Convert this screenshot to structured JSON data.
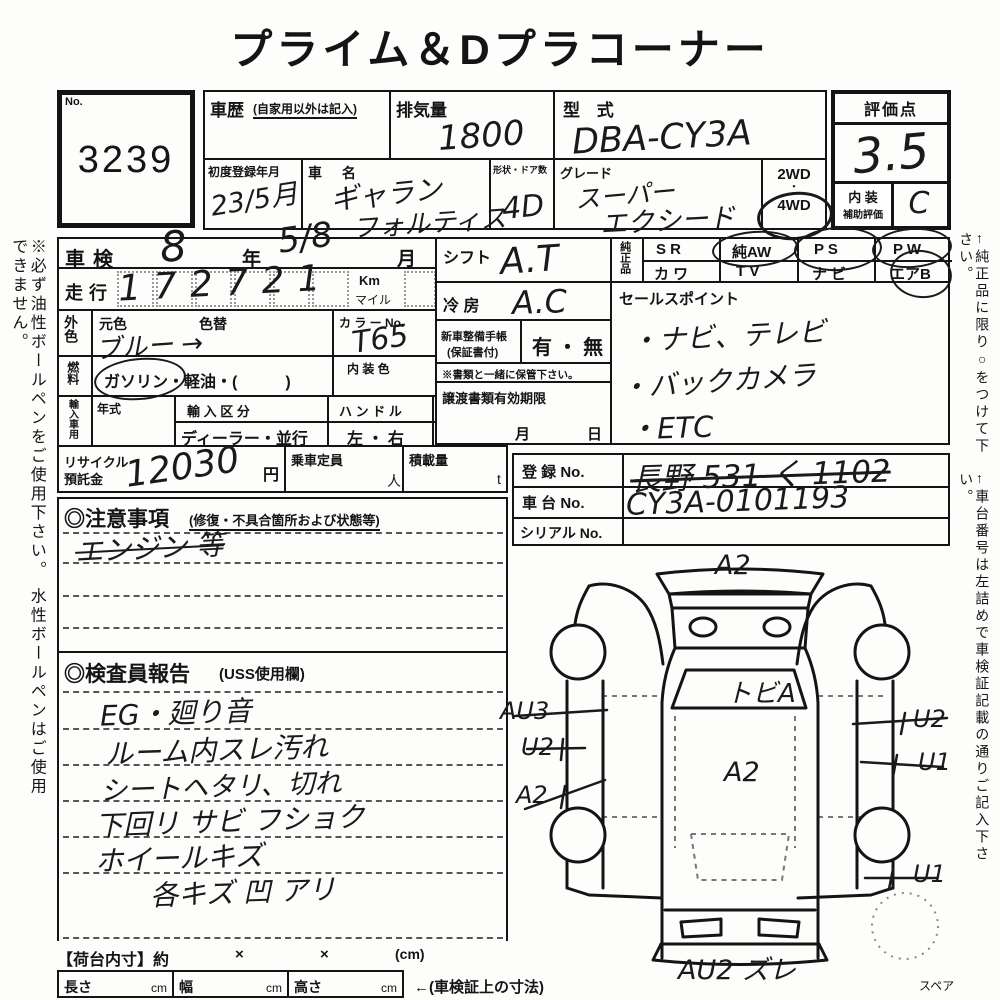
{
  "title": "プライム＆Dプラコーナー",
  "side_notes": {
    "left": "※必ず油性ボールペンをご使用下さい。 水性ボールペンはご使用できません。",
    "right_top": "←純正品に限り○をつけて下さい。",
    "right_bottom": "←車台番号は左詰めで車検証記載の通りご記入下さい。"
  },
  "lot": {
    "label": "No.",
    "number": "3239"
  },
  "header": {
    "history": {
      "label": "車歴",
      "note": "(自家用以外は記入)"
    },
    "displacement": {
      "label": "排気量",
      "value": "1800"
    },
    "model_code": {
      "label": "型 式",
      "value": "DBA-CY3A"
    },
    "first_reg": {
      "label": "初度登録年月",
      "value": "23/5月"
    },
    "car_name": {
      "label": "車 名",
      "line1": "ギャラン",
      "line2": "フォルティス"
    },
    "body_doors": {
      "label": "形状・ドア数",
      "value": "4D"
    },
    "grade": {
      "label": "グレード",
      "line1": "スーパー",
      "line2": "エクシード"
    },
    "drive": {
      "opt1": "2WD",
      "sep": "・",
      "opt2": "4WD",
      "selected": "4WD"
    }
  },
  "score": {
    "label": "評価点",
    "value": "3.5",
    "interior_label1": "内 装",
    "interior_label2": "補助評価",
    "interior_value": "C"
  },
  "left_col": {
    "shaken": {
      "label": "車検",
      "year_value": "8",
      "year_unit": "年",
      "month_value": "5/8",
      "month_unit": "月"
    },
    "mileage": {
      "label": "走行",
      "value": "172721",
      "unit_km": "Km",
      "unit_mile": "マイル"
    },
    "color": {
      "label": "外色",
      "orig_label": "元色",
      "repaint_label": "色替",
      "value": "ブルー →",
      "colorno_label": "カ ラ ー No.",
      "colorno_value": "T65"
    },
    "fuel": {
      "label": "燃料",
      "options": "ガソリン・軽油・(　　　)",
      "selected": "ガソリン",
      "interior_color_label": "内 装 色"
    },
    "import": {
      "label": "輸入車用",
      "year_label": "年式",
      "division_label": "輸 入 区 分",
      "division_options": "ディーラー・並行",
      "handle_label": "ハ ン ド ル",
      "handle_options": "左 ・ 右"
    },
    "recycle": {
      "label1": "リサイクル",
      "label2": "預託金",
      "value": "12030",
      "unit": "円",
      "capacity_label": "乗車定員",
      "capacity_unit": "人",
      "load_label": "積載量",
      "load_unit": "t"
    }
  },
  "mid_col": {
    "shift": {
      "label": "シフト",
      "value": "A.T"
    },
    "ac": {
      "label": "冷 房",
      "value": "A.C"
    },
    "service_book": {
      "label1": "新車整備手帳",
      "label2": "(保証書付)",
      "options": "有 ・ 無"
    },
    "keep_note": "※書類と一緒に保管下さい。",
    "transfer": {
      "label": "譲渡書類有効期限",
      "month": "月",
      "day": "日"
    }
  },
  "genuine": {
    "label": "純正品",
    "cells": [
      {
        "top": "S R",
        "bottom": "カ ワ"
      },
      {
        "top": "純AW",
        "bottom": "T V"
      },
      {
        "top": "P S",
        "bottom": "ナ ビ"
      },
      {
        "top": "P W",
        "bottom": "エアB"
      }
    ],
    "circled": [
      "純AW",
      "P S",
      "P W",
      "エアB"
    ]
  },
  "sales_point": {
    "label": "セールスポイント",
    "lines": [
      "・ナビ、テレビ",
      "・バックカメラ",
      "・ETC"
    ]
  },
  "registration": {
    "reg_label": "登 録 No.",
    "reg_value": "長野 531 く 1102",
    "chassis_label": "車 台 No.",
    "chassis_value": "CY3A-0101193",
    "serial_label": "シリアル No.",
    "serial_value": ""
  },
  "caution": {
    "heading": "◎注意事項",
    "sub": "(修復・不具合箇所および状態等)",
    "note": "エンジン 等"
  },
  "inspector": {
    "heading": "◎検査員報告",
    "sub": "(USS使用欄)",
    "lines": [
      "EG・廻り音",
      "ルーム内スレ汚れ",
      "シートヘタリ、切れ",
      "下回リ サビ フショク",
      "ホイールキズ",
      "各キズ 凹 アリ"
    ]
  },
  "diagram": {
    "top": "A2",
    "windshield": "トビA",
    "roof": "A2",
    "left1": "AU3",
    "left2": "U2",
    "left3": "A2",
    "right1": "U2",
    "right2": "U1",
    "right3": "U1",
    "bottom": "AU2  ズレ",
    "spare": "スペア"
  },
  "footer": {
    "bed_label": "【荷台内寸】約",
    "x1": "×",
    "x2": "×",
    "cm_note": "(cm)",
    "length_label": "長さ",
    "length_unit": "cm",
    "width_label": "幅",
    "width_unit": "cm",
    "height_label": "高さ",
    "height_unit": "cm",
    "dims_note": "←(車検証上の寸法)"
  }
}
